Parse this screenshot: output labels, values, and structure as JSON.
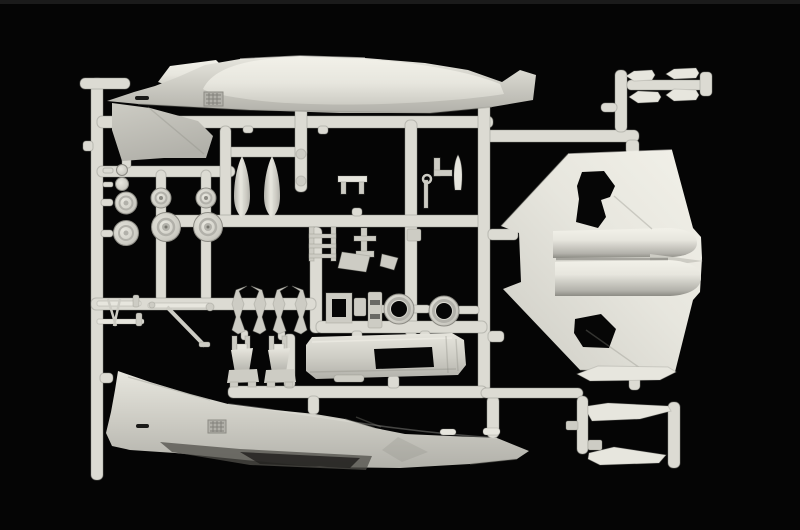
{
  "image": {
    "kind": "photograph",
    "subject": "Injection-molded plastic model kit sprue (light grey styrene runner frame with aircraft parts) photographed on a black background",
    "aircraft_style": "F-4 Phantom II jet model parts",
    "parts": [
      {
        "name": "fuselage-half-top",
        "desc": "fuselage half, nose left, tail fin pointing down",
        "count": 1
      },
      {
        "name": "fuselage-half-bottom",
        "desc": "fuselage half, tail fin left, nose right",
        "count": 1
      },
      {
        "name": "one-piece-lower-wing",
        "desc": "large delta wing with engine fairings and open gear bays",
        "count": 1
      },
      {
        "name": "horizontal-stabilizer-blades",
        "count": 3
      },
      {
        "name": "missile-and-pod-halves",
        "count": 4
      },
      {
        "name": "drop-tank-halves",
        "count": 2
      },
      {
        "name": "wheels-and-hubs",
        "count": 6
      },
      {
        "name": "engine-intake-rings",
        "count": 2
      },
      {
        "name": "cockpit-tub-with-opening",
        "count": 1
      },
      {
        "name": "ejection-seats",
        "count": 2
      },
      {
        "name": "intake-duct-brackets",
        "count": 4
      },
      {
        "name": "landing-gear-struts",
        "count": 3
      },
      {
        "name": "small-detail-parts",
        "count": 12
      }
    ]
  },
  "colors": {
    "bg": "#050505",
    "topstrip": "#1b1b1b",
    "runner": "#dcdbd3",
    "runneredge": "#8f8e87",
    "highlight": "#f2f1e9",
    "light": "#e7e6de",
    "mid": "#cdccc4",
    "deep": "#b2b1aa",
    "shadow": "#8c8b84",
    "dark": "#504f4a",
    "hole": "#060606"
  }
}
